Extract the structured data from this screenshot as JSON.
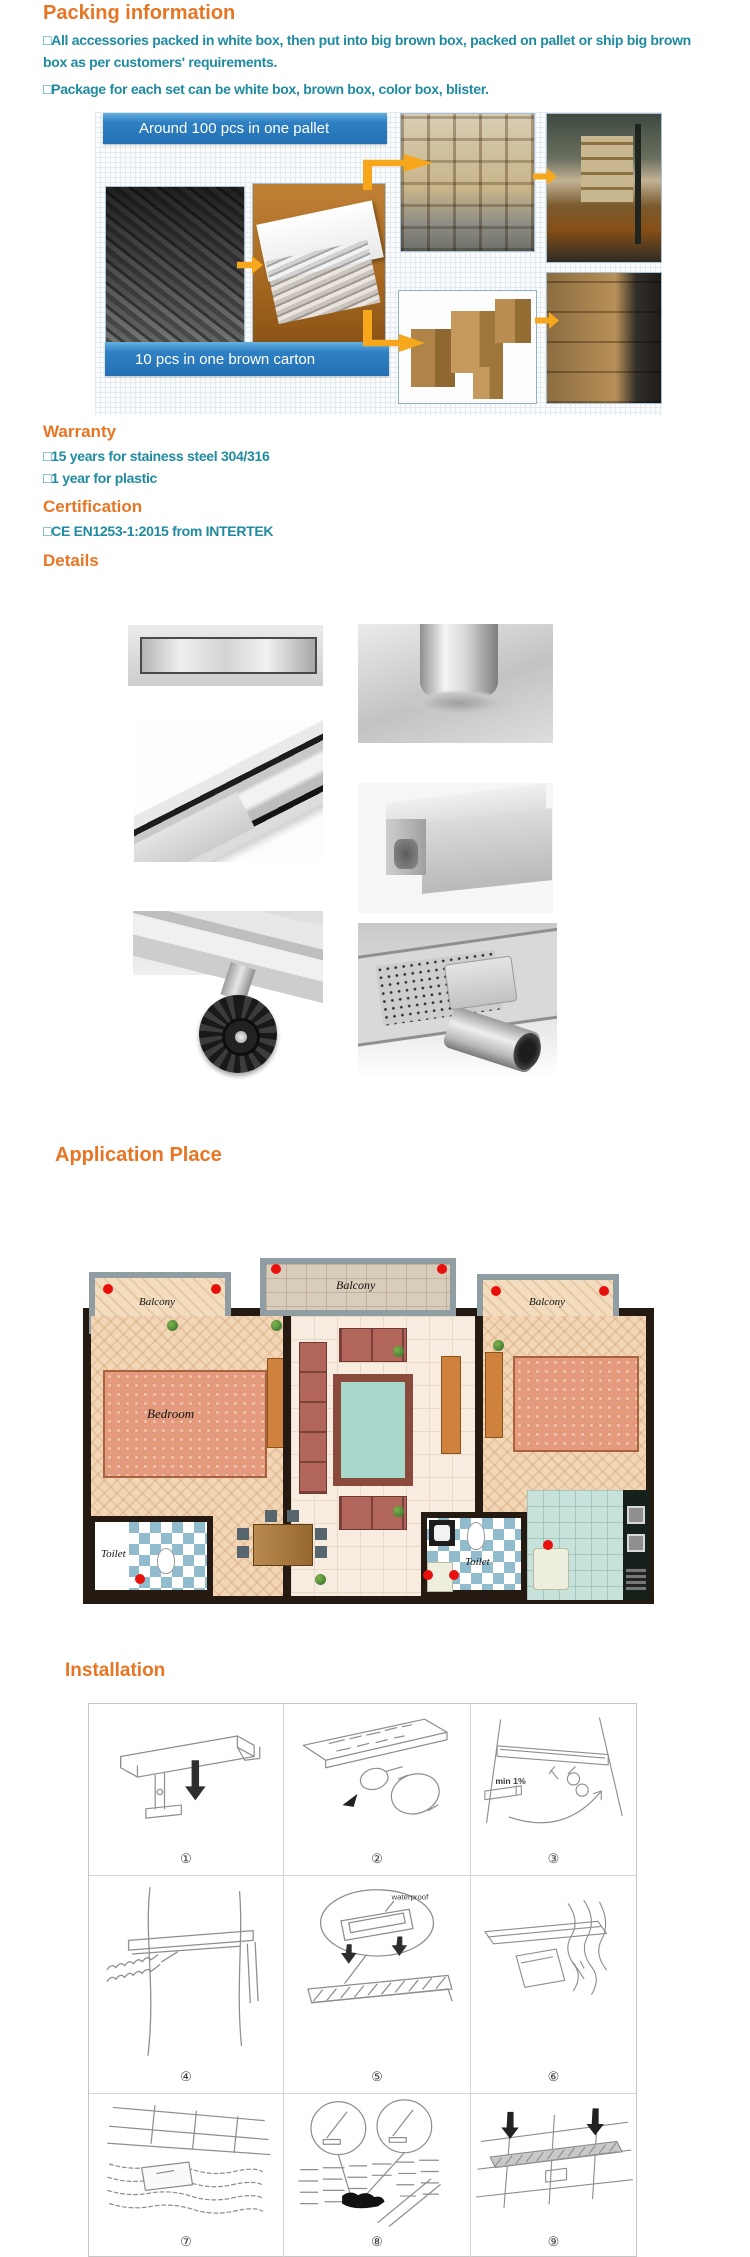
{
  "colors": {
    "heading_orange": "#E87523",
    "body_teal": "#1F8BA0",
    "banner_blue": "#2E80C3",
    "arrow_orange": "#F6A71B",
    "drain_dot_red": "#E8100C"
  },
  "packing": {
    "title": "Packing information",
    "bullets": [
      "□All accessories packed in white box, then put into big brown box, packed on pallet or ship big brown box as per customers' requirements.",
      "□Package for each set can be white box, brown box, color box, blister."
    ],
    "banner_pallet": "Around 100 pcs in one pallet",
    "banner_carton": "10 pcs in one brown carton",
    "photos": [
      "drain-channels-stacked",
      "drain-in-white-box",
      "wooden-crates-on-pallet",
      "forklift-loading-container",
      "brown-cartons",
      "cartons-on-pallet-forklift"
    ]
  },
  "warranty": {
    "title": "Warranty",
    "bullets": [
      "□15 years for stainess steel 304/316",
      "□1 year for plastic"
    ]
  },
  "certification": {
    "title": "Certification",
    "bullets": [
      "□CE EN1253-1:2015 from INTERTEK"
    ]
  },
  "details": {
    "title": "Details",
    "photos": [
      "channel-top-view",
      "round-pipe-outlet",
      "channel-angled-view",
      "square-outlet-box",
      "adjustable-foot",
      "perforated-body-side-outlet"
    ]
  },
  "application": {
    "title": "Application Place",
    "labels": {
      "balcony_top": "Balcony",
      "balcony_left": "Balcony",
      "balcony_right": "Balcony",
      "bedroom": "Bedroom",
      "toilet_left": "Toilet",
      "toilet_right": "Toilet"
    }
  },
  "installation": {
    "title": "Installation",
    "steps": [
      "①",
      "②",
      "③",
      "④",
      "⑤",
      "⑥",
      "⑦",
      "⑧",
      "⑨"
    ],
    "annotations": {
      "min_slope": "min 1%",
      "waterproof": "waterproof"
    }
  }
}
